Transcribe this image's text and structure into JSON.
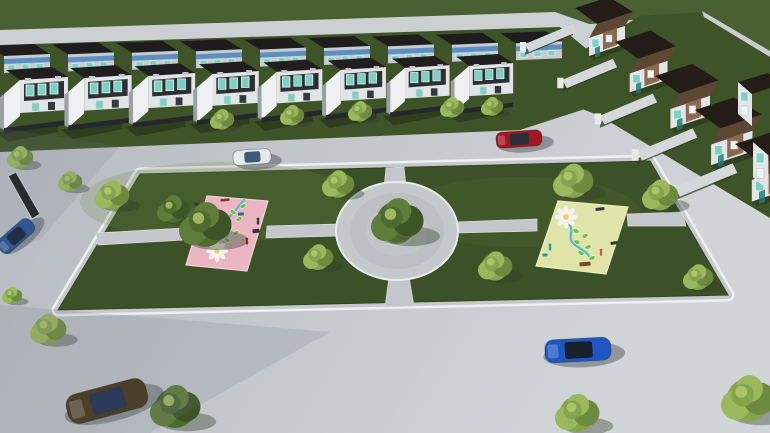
{
  "scene": {
    "name": "aerial-architectural-render-neighborhood-park",
    "palette": {
      "road_left": "#b4b9bf",
      "road_right": "#d2d5d8",
      "road_top": "#cdd0d3",
      "field_green": "#4a6033",
      "lawn_green": "#3f5329",
      "park_green": "#3c5127",
      "path_gray": "#c3c6ca",
      "curb_white": "#eef0f2",
      "sidewalk_gray": "#c5c8cc",
      "roof_dark": "#211e1f",
      "roof_back": "#1f1c1d",
      "facade_white": "#e2e5e7",
      "facade_inset": "#2c3035",
      "window_teal": "#7ed0c2",
      "window_blue": "#5d8fc2",
      "divider_wall": "#eef0f2",
      "fence_dark": "#24282c",
      "cluster_roof_dark": "#241d17",
      "cluster_roof_brown": "#5c4832",
      "cluster_brick": "#8a6a50",
      "cluster_door": "#3d8f8a",
      "garden_wall": "#d5d8da",
      "mat_pink": "#e9b6c2",
      "mat_yellow": "#e0e4a8",
      "flower_white": "#f6f3ec",
      "flower_core": "#e4cf7c",
      "stem_blue": "#56b5d6",
      "leaf_green": "#79c045",
      "shadow_blue": "#6d7684",
      "planter_rim": "#8f9499",
      "planter_soil": "#27331d"
    },
    "ground": {
      "field": "0,0 770,0 770,62 704,13 560,27 0,44",
      "top_road": "0,30 555,12 655,47 545,92 420,40 0,47",
      "left_lawn": "0,45 560,27 600,60 588,108 520,130 0,152",
      "cluster_lawn": "524,86 640,16 704,12 770,54 770,218 600,116",
      "ne_wall": "702,11 770,51 770,57 704,17",
      "dark_hedge_wall": "8,176 16,172 40,214 32,219"
    },
    "park": {
      "outline": "140,174 650,161 728,295 58,310",
      "highlights": [
        {
          "cx": 220,
          "cy": 202,
          "rx": 140,
          "ry": 40,
          "o": 0.22
        },
        {
          "cx": 520,
          "cy": 212,
          "rx": 120,
          "ry": 35,
          "o": 0.13
        }
      ],
      "paths": [
        "386,168 404,167 406,186 384,187",
        "389,277 409,277 414,306 385,307",
        "96,233 184,228 184,240 98,245",
        "267,226 338,224 338,236 266,238",
        "456,222 537,219 537,231 456,233",
        "627,214 682,212 686,226 628,226"
      ],
      "plaza": {
        "cx": 397,
        "cy": 231,
        "rx": 61,
        "ry": 49
      }
    },
    "playgrounds": [
      {
        "name": "pink-playground-mat",
        "color": "#e9b6c2",
        "edge": "#f2d3da",
        "outline": "207,196 268,201 247,271 186,265",
        "flower": {
          "cx": 217,
          "cy": 251,
          "s": 1.0
        },
        "stem": "M221,246 C228,238 230,232 226,226 C222,220 232,216 236,210 C240,205 242,202 244,200",
        "leaves": [
          [
            227,
            240
          ],
          [
            236,
            233
          ],
          [
            229,
            226
          ],
          [
            239,
            219
          ],
          [
            233,
            212
          ],
          [
            243,
            206
          ]
        ],
        "equipment": [
          {
            "x": 225,
            "y": 200,
            "w": 9,
            "h": 2.5,
            "a": -6,
            "c": "#8a3020"
          },
          {
            "x": 198,
            "y": 205,
            "w": 8,
            "h": 3,
            "a": 28,
            "c": "#33383d"
          },
          {
            "x": 256,
            "y": 231,
            "w": 7,
            "h": 4,
            "a": -5,
            "c": "#33383d"
          },
          {
            "x": 241,
            "y": 214,
            "w": 6,
            "h": 3,
            "a": 0,
            "c": "#2f6d8a"
          }
        ],
        "figures": [
          {
            "x": 258,
            "y": 222,
            "c": "#30353b"
          },
          {
            "x": 247,
            "y": 242,
            "c": "#8a2f3a"
          }
        ]
      },
      {
        "name": "yellow-playground-mat",
        "color": "#e0e4a8",
        "edge": "#edefc8",
        "outline": "558,201 628,207 606,274 536,266",
        "flower": {
          "cx": 566,
          "cy": 217,
          "s": 1.05
        },
        "stem": "M569,224 C575,231 567,237 573,243 C579,249 585,250 589,256",
        "leaves": [
          [
            576,
            231
          ],
          [
            585,
            236
          ],
          [
            577,
            242
          ],
          [
            588,
            247
          ],
          [
            581,
            253
          ],
          [
            592,
            258
          ]
        ],
        "equipment": [
          {
            "x": 600,
            "y": 209,
            "w": 9,
            "h": 3,
            "a": -5,
            "c": "#33383d"
          },
          {
            "x": 614,
            "y": 243,
            "w": 7,
            "h": 3,
            "a": -8,
            "c": "#33383d"
          },
          {
            "x": 585,
            "y": 264,
            "w": 11,
            "h": 4,
            "a": -4,
            "c": "#7a4a28"
          },
          {
            "x": 545,
            "y": 255,
            "w": 5,
            "h": 3,
            "a": 0,
            "c": "#2a9d8f"
          }
        ],
        "figures": [
          {
            "x": 550,
            "y": 248,
            "c": "#2a9d8f"
          },
          {
            "x": 601,
            "y": 253,
            "c": "#c06050"
          }
        ]
      }
    ],
    "townhouses": {
      "back_row": {
        "count": 9,
        "x0": -12,
        "y0": 46,
        "dx": 64,
        "dy": -1.6
      },
      "front_row": {
        "count": 8,
        "x0": -8,
        "y0": 70,
        "dx": 64.5,
        "dy": -1.9,
        "dscale": 0.012
      }
    },
    "cluster": {
      "count": 5,
      "x0": 575,
      "y0": 8,
      "dx": 40,
      "dy": 34,
      "dscale": 0.05
    },
    "edge_houses": [
      {
        "x": 738,
        "y": 82,
        "s": 1.0
      },
      {
        "x": 753,
        "y": 142,
        "s": 1.1
      }
    ],
    "trees": [
      {
        "x": 20,
        "y": 158,
        "r": 13,
        "tone": "light"
      },
      {
        "x": 222,
        "y": 120,
        "r": 12,
        "tone": "light"
      },
      {
        "x": 292,
        "y": 116,
        "r": 12,
        "tone": "light"
      },
      {
        "x": 360,
        "y": 112,
        "r": 12,
        "tone": "light"
      },
      {
        "x": 452,
        "y": 108,
        "r": 12,
        "tone": "light"
      },
      {
        "x": 492,
        "y": 107,
        "r": 11,
        "tone": "light"
      },
      {
        "x": 70,
        "y": 182,
        "r": 12,
        "tone": "light"
      },
      {
        "x": 112,
        "y": 196,
        "r": 17,
        "tone": "light"
      },
      {
        "x": 173,
        "y": 210,
        "r": 16,
        "tone": "dark"
      },
      {
        "x": 205,
        "y": 226,
        "r": 26,
        "tone": "dark"
      },
      {
        "x": 338,
        "y": 185,
        "r": 16,
        "tone": "light"
      },
      {
        "x": 573,
        "y": 182,
        "r": 20,
        "tone": "light"
      },
      {
        "x": 660,
        "y": 196,
        "r": 18,
        "tone": "light"
      },
      {
        "x": 318,
        "y": 258,
        "r": 15,
        "tone": "light"
      },
      {
        "x": 495,
        "y": 267,
        "r": 17,
        "tone": "light"
      },
      {
        "x": 698,
        "y": 278,
        "r": 15,
        "tone": "light"
      },
      {
        "x": 397,
        "y": 222,
        "r": 26,
        "tone": "dark"
      },
      {
        "x": 48,
        "y": 330,
        "r": 18,
        "tone": "light"
      },
      {
        "x": 12,
        "y": 296,
        "r": 10,
        "tone": "light"
      },
      {
        "x": 175,
        "y": 408,
        "r": 25,
        "tone": "dark"
      },
      {
        "x": 577,
        "y": 414,
        "r": 22,
        "tone": "light"
      },
      {
        "x": 748,
        "y": 400,
        "r": 27,
        "tone": "light"
      }
    ],
    "cars": [
      {
        "name": "car-white-hatchback",
        "x": 252,
        "y": 157,
        "angle": -4,
        "len": 38,
        "wid": 15,
        "body": "#e3e8ea",
        "glass": "#3d5a77"
      },
      {
        "name": "car-red-sedan",
        "x": 519,
        "y": 139,
        "angle": -4,
        "len": 46,
        "wid": 16,
        "body": "#a31622",
        "glass": "#2a2f3a"
      },
      {
        "name": "car-blue-sedan",
        "x": 578,
        "y": 350,
        "angle": -3,
        "len": 66,
        "wid": 23,
        "body": "#1f56c4",
        "glass": "#16202e"
      },
      {
        "name": "car-brown-sedan",
        "x": 107,
        "y": 401,
        "angle": -15,
        "len": 82,
        "wid": 30,
        "body": "#453414",
        "glass": "#1e2c4e"
      },
      {
        "name": "car-dark-blue-hatchback",
        "x": 16,
        "y": 236,
        "angle": -41,
        "len": 42,
        "wid": 17,
        "body": "#2a4f92",
        "glass": "#14213a"
      }
    ],
    "shade_overlays": [
      {
        "pts": "0,305 330,332 150,433 0,433",
        "o": 0.18
      },
      {
        "pts": "0,128 120,146 40,240 0,252",
        "o": 0.15
      }
    ]
  }
}
